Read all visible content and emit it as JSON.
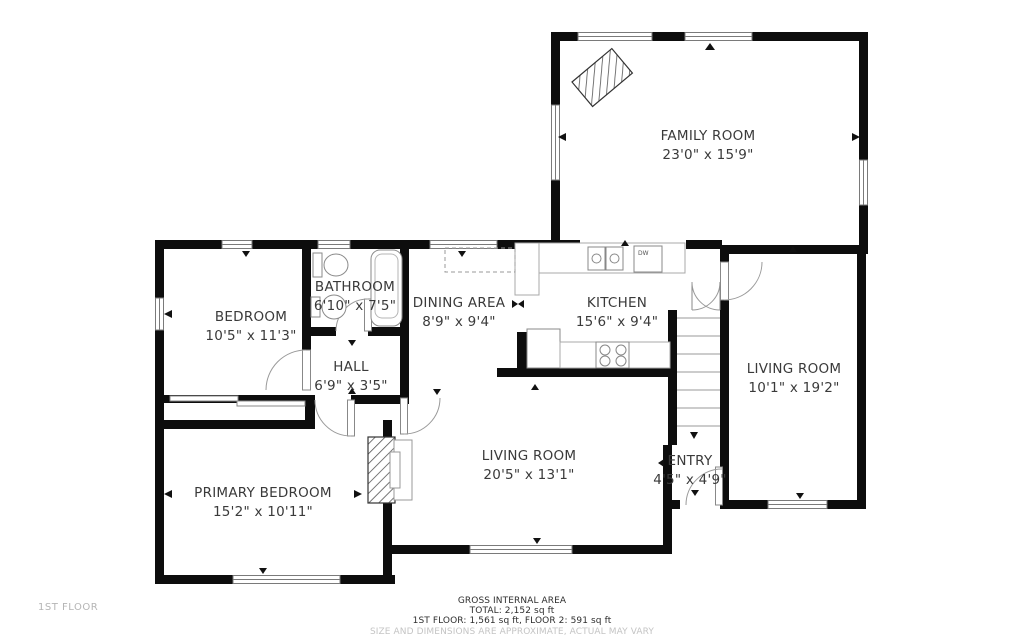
{
  "page": {
    "background": "#ffffff",
    "wall_color": "#0d0d0d",
    "label_color": "#3a3a3a",
    "muted_color": "#b5b5b5"
  },
  "floor_label": "1ST FLOOR",
  "footer": {
    "line1": "GROSS INTERNAL AREA",
    "line2": "TOTAL: 2,152 sq ft",
    "line3": "1ST FLOOR: 1,561 sq ft, FLOOR 2: 591 sq ft",
    "disclaimer": "SIZE AND DIMENSIONS ARE APPROXIMATE, ACTUAL MAY VARY"
  },
  "rooms": {
    "family_room": {
      "name": "FAMILY ROOM",
      "dims": "23'0\" x 15'9\""
    },
    "bedroom": {
      "name": "BEDROOM",
      "dims": "10'5\" x 11'3\""
    },
    "bathroom": {
      "name": "BATHROOM",
      "dims": "6'10\" x 7'5\""
    },
    "hall": {
      "name": "HALL",
      "dims": "6'9\" x 3'5\""
    },
    "dining_area": {
      "name": "DINING AREA",
      "dims": "8'9\" x 9'4\""
    },
    "kitchen": {
      "name": "KITCHEN",
      "dims": "15'6\" x 9'4\""
    },
    "living_room_center": {
      "name": "LIVING ROOM",
      "dims": "20'5\" x 13'1\""
    },
    "living_room_right": {
      "name": "LIVING ROOM",
      "dims": "10'1\" x 19'2\""
    },
    "primary_bedroom": {
      "name": "PRIMARY BEDROOM",
      "dims": "15'2\" x 10'11\""
    },
    "entry": {
      "name": "ENTRY",
      "dims": "4'5\" x 4'9\""
    }
  },
  "fixtures": {
    "dishwasher_label": "DW"
  }
}
